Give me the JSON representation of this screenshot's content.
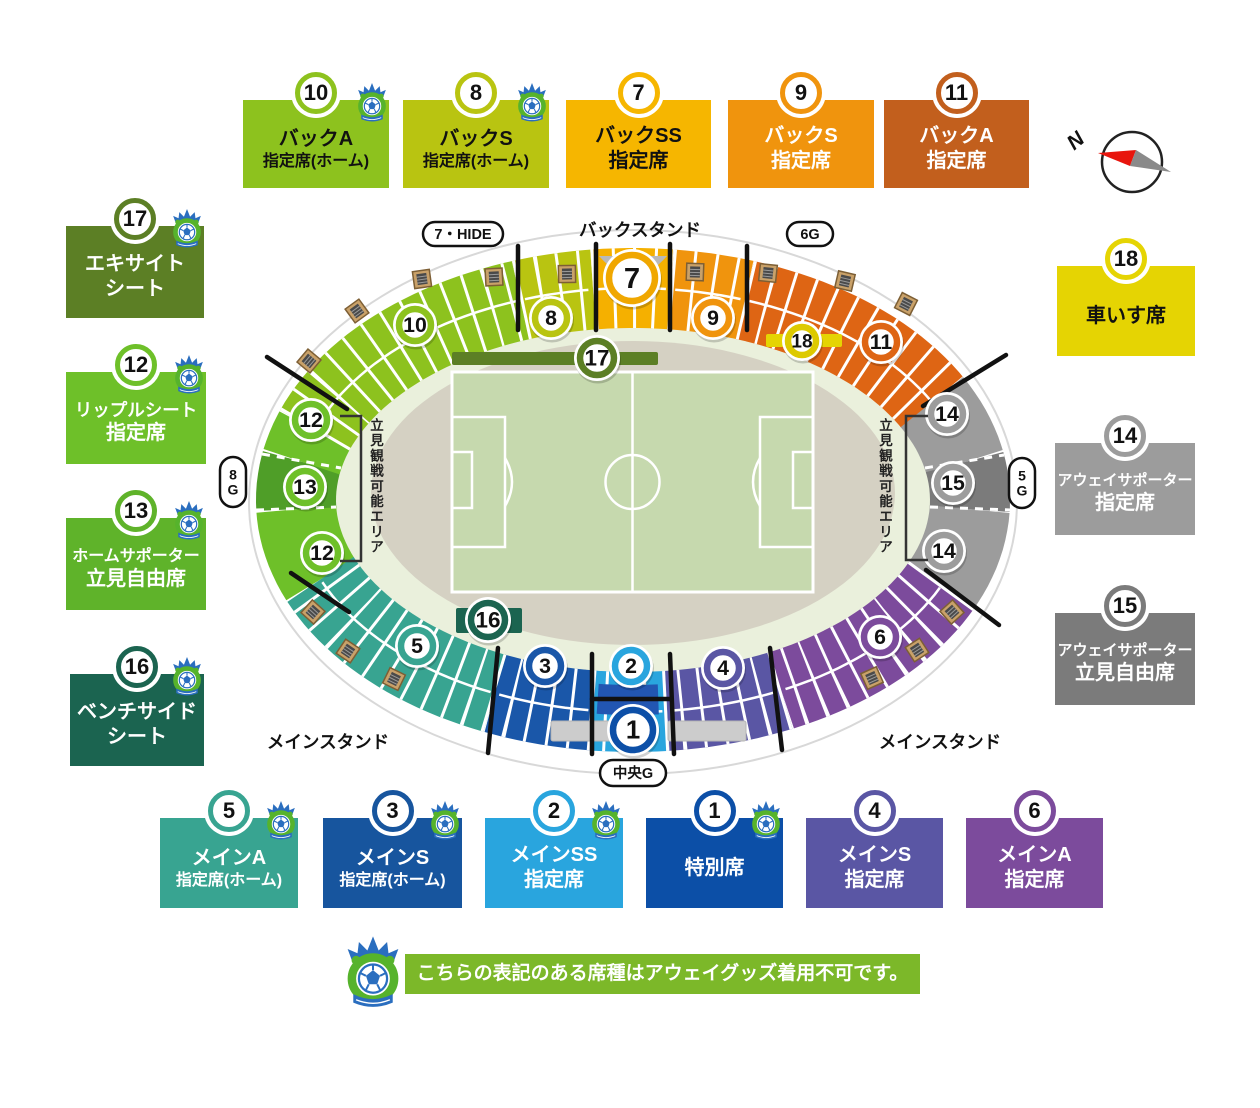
{
  "note": {
    "text": "こちらの表記のある席種はアウェイグッズ着用不可です。"
  },
  "stadium": {
    "center": {
      "x": 633,
      "y": 500
    },
    "ring": {
      "rx": 337,
      "ry": 212,
      "width": 80
    },
    "silhouette": {
      "rx": 384,
      "ry": 272,
      "fill": "#ffffff",
      "stroke": "#d8d8d8"
    },
    "concourse": {
      "rx": 302,
      "ry": 190,
      "cy": 500,
      "fill": "#eaf0dc"
    },
    "track": {
      "rx": 262,
      "ry": 152,
      "cy": 493,
      "fill": "#d5d1c3"
    },
    "field": {
      "x": 452,
      "y": 372,
      "w": 361,
      "h": 220,
      "grass": "#c6d9ae",
      "line": "#ffffff"
    },
    "sections": [
      {
        "id": "12",
        "from": 158,
        "to": 177.5,
        "color": "#6ec029",
        "blocks": false
      },
      {
        "id": "13",
        "from": 177.5,
        "to": 190.4,
        "color": "#4f9e28",
        "blocks": false
      },
      {
        "id": "12",
        "from": 190.4,
        "to": 199.2,
        "color": "#6ec029",
        "blocks": false
      },
      {
        "id": "10",
        "from": 199.2,
        "to": 250.5,
        "color": "#8dc21e",
        "blocks": true
      },
      {
        "id": "8",
        "from": 250.5,
        "to": 263.2,
        "color": "#b9c411",
        "blocks": true
      },
      {
        "id": "7",
        "from": 263.2,
        "to": 276.4,
        "color": "#f5b000",
        "blocks": true
      },
      {
        "id": "9",
        "from": 276.4,
        "to": 289.4,
        "color": "#f0940d",
        "blocks": true
      },
      {
        "id": "11",
        "from": 289.4,
        "to": 332.5,
        "color": "#de6514",
        "blocks": true
      },
      {
        "id": "14",
        "from": 332.5,
        "to": 349.7,
        "color": "#9c9c9c",
        "blocks": false
      },
      {
        "id": "15",
        "from": 349.7,
        "to": 362.5,
        "color": "#7b7b7b",
        "blocks": false
      },
      {
        "id": "14",
        "from": 2.5,
        "to": 23.6,
        "color": "#9c9c9c",
        "blocks": false
      },
      {
        "id": "6",
        "from": 23.6,
        "to": 63.9,
        "color": "#7c4b9c",
        "blocks": true
      },
      {
        "id": "4",
        "from": 63.9,
        "to": 84.2,
        "color": "#5a56a4",
        "blocks": true
      },
      {
        "id": "2",
        "from": 84.2,
        "to": 96.8,
        "color": "#29a5de",
        "blocks": true
      },
      {
        "id": "3",
        "from": 96.8,
        "to": 114.2,
        "color": "#1a57a9",
        "blocks": true
      },
      {
        "id": "5",
        "from": 114.2,
        "to": 158,
        "color": "#38a491",
        "blocks": true
      }
    ],
    "inner_arcs": [
      {
        "id": "1",
        "from": 85.5,
        "to": 96.3,
        "rx": 322,
        "ry": 200,
        "width": 30,
        "color": "#2256b2"
      }
    ],
    "bars": [
      {
        "id": "17",
        "x": 452,
        "y": 352,
        "w": 206,
        "h": 13,
        "color": "#5c7f25"
      },
      {
        "id": "18",
        "x": 766,
        "y": 334,
        "w": 76,
        "h": 13,
        "color": "#e5d403"
      },
      {
        "id": "16",
        "x": 456,
        "y": 608,
        "w": 66,
        "h": 25,
        "color": "#1b6450"
      }
    ],
    "roof": {
      "path": "M599,256 L667,256 Q648,277 633,278 Q618,277 599,256 Z",
      "color": "#b9b9b9"
    },
    "tunnels": [
      {
        "x": 551,
        "y": 721,
        "w": 70,
        "h": 20
      },
      {
        "x": 668,
        "y": 721,
        "w": 78,
        "h": 20
      }
    ],
    "badges": [
      {
        "n": "10",
        "x": 415,
        "y": 325,
        "r": 19,
        "ring": "#8dc21e"
      },
      {
        "n": "8",
        "x": 551,
        "y": 318,
        "r": 19,
        "ring": "#b9c411"
      },
      {
        "n": "7",
        "x": 632,
        "y": 278,
        "r": 26,
        "ring": "#f0a700"
      },
      {
        "n": "9",
        "x": 713,
        "y": 318,
        "r": 19,
        "ring": "#f0940d"
      },
      {
        "n": "11",
        "x": 881,
        "y": 342,
        "r": 19,
        "ring": "#de6514"
      },
      {
        "n": "18",
        "x": 802,
        "y": 341,
        "r": 17,
        "ring": "#ddca00"
      },
      {
        "n": "17",
        "x": 597,
        "y": 358,
        "r": 20,
        "ring": "#5c7f25"
      },
      {
        "n": "12",
        "x": 311,
        "y": 420,
        "r": 19,
        "ring": "#6ec029"
      },
      {
        "n": "13",
        "x": 305,
        "y": 487,
        "r": 19,
        "ring": "#6ec029"
      },
      {
        "n": "12",
        "x": 322,
        "y": 553,
        "r": 19,
        "ring": "#6ec029"
      },
      {
        "n": "14",
        "x": 947,
        "y": 414,
        "r": 19,
        "ring": "#9c9c9c"
      },
      {
        "n": "15",
        "x": 953,
        "y": 483,
        "r": 19,
        "ring": "#9c9c9c"
      },
      {
        "n": "14",
        "x": 944,
        "y": 551,
        "r": 19,
        "ring": "#9c9c9c"
      },
      {
        "n": "5",
        "x": 417,
        "y": 646,
        "r": 19,
        "ring": "#38a491"
      },
      {
        "n": "16",
        "x": 488,
        "y": 620,
        "r": 20,
        "ring": "#1b6450"
      },
      {
        "n": "3",
        "x": 545,
        "y": 666,
        "r": 19,
        "ring": "#1a57a9"
      },
      {
        "n": "2",
        "x": 631,
        "y": 666,
        "r": 19,
        "ring": "#29a5de"
      },
      {
        "n": "1",
        "x": 633,
        "y": 730,
        "r": 23,
        "ring": "#0c4fa7"
      },
      {
        "n": "4",
        "x": 723,
        "y": 668,
        "r": 19,
        "ring": "#5a56a4"
      },
      {
        "n": "6",
        "x": 880,
        "y": 637,
        "r": 19,
        "ring": "#7c4b9c"
      }
    ],
    "doors": [
      {
        "x": 422,
        "y": 279,
        "rot": -8
      },
      {
        "x": 494,
        "y": 277,
        "rot": -3
      },
      {
        "x": 567,
        "y": 274,
        "rot": -1
      },
      {
        "x": 695,
        "y": 272,
        "rot": 2
      },
      {
        "x": 768,
        "y": 273,
        "rot": 6
      },
      {
        "x": 845,
        "y": 281,
        "rot": 13
      },
      {
        "x": 906,
        "y": 304,
        "rot": 27
      },
      {
        "x": 357,
        "y": 311,
        "rot": -36
      },
      {
        "x": 309,
        "y": 361,
        "rot": -50
      },
      {
        "x": 313,
        "y": 612,
        "rot": 42
      },
      {
        "x": 348,
        "y": 651,
        "rot": 34
      },
      {
        "x": 394,
        "y": 679,
        "rot": 26
      },
      {
        "x": 952,
        "y": 612,
        "rot": -42
      },
      {
        "x": 917,
        "y": 650,
        "rot": -33
      },
      {
        "x": 872,
        "y": 678,
        "rot": -24
      }
    ],
    "dividers_black": [
      [
        518,
        246,
        518,
        330
      ],
      [
        596,
        244,
        596,
        330
      ],
      [
        670,
        244,
        670,
        330
      ],
      [
        747,
        246,
        747,
        330
      ],
      [
        267,
        357,
        347,
        409
      ],
      [
        291,
        573,
        349,
        612
      ],
      [
        923,
        406,
        1006,
        355
      ],
      [
        926,
        570,
        999,
        625
      ],
      [
        498,
        648,
        488,
        753
      ],
      [
        592,
        654,
        592,
        754
      ],
      [
        670,
        654,
        674,
        754
      ],
      [
        770,
        648,
        782,
        750
      ],
      [
        592,
        699,
        671,
        699
      ]
    ],
    "dividers_dashed": [
      [
        262,
        454,
        341,
        468
      ],
      [
        256,
        510,
        336,
        507
      ],
      [
        925,
        468,
        1004,
        455
      ],
      [
        930,
        507,
        1010,
        510
      ]
    ],
    "gates": [
      {
        "text": "7・HIDE",
        "x": 463,
        "y": 234,
        "w": 80,
        "h": 24,
        "vertical": false
      },
      {
        "text": "6G",
        "x": 810,
        "y": 234,
        "w": 46,
        "h": 24,
        "vertical": false
      },
      {
        "text": "8G",
        "x": 233,
        "y": 482,
        "w": 26,
        "h": 50,
        "vertical": true
      },
      {
        "text": "5G",
        "x": 1022,
        "y": 483,
        "w": 26,
        "h": 50,
        "vertical": true
      },
      {
        "text": "中央G",
        "x": 633,
        "y": 773,
        "w": 66,
        "h": 26,
        "vertical": false
      }
    ],
    "stand_labels": [
      {
        "text": "バックスタンド",
        "x": 640,
        "y": 236
      },
      {
        "text": "メインスタンド",
        "x": 328,
        "y": 748
      },
      {
        "text": "メインスタンド",
        "x": 940,
        "y": 748
      }
    ],
    "standing_areas": [
      {
        "text": "立見観戦可能エリア",
        "x": 377,
        "y": 430,
        "step": 15.2,
        "bracket": "M340,416 L361,416 L361,561 L340,561"
      },
      {
        "text": "立見観戦可能エリア",
        "x": 886,
        "y": 430,
        "step": 15.2,
        "bracket": "M928,416 L906,416 L906,560 L928,560"
      }
    ],
    "compass": {
      "cx": 1132,
      "cy": 162,
      "r": 30,
      "label": "N",
      "needle_red": "#e8150d",
      "needle_gray": "#8a8a8a"
    }
  },
  "cards": [
    {
      "id": "10",
      "x": 243,
      "y": 100,
      "w": 146,
      "h": 88,
      "bg": "#8dc21e",
      "text": "#111111",
      "lines": [
        "バックA",
        "指定席(ホーム)"
      ],
      "mascot": true
    },
    {
      "id": "8",
      "x": 403,
      "y": 100,
      "w": 146,
      "h": 88,
      "bg": "#b9c411",
      "text": "#111111",
      "lines": [
        "バックS",
        "指定席(ホーム)"
      ],
      "mascot": true
    },
    {
      "id": "7",
      "x": 566,
      "y": 100,
      "w": 145,
      "h": 88,
      "bg": "#f6b600",
      "text": "#111111",
      "lines": [
        "バックSS",
        "指定席"
      ],
      "mascot": false
    },
    {
      "id": "9",
      "x": 728,
      "y": 100,
      "w": 146,
      "h": 88,
      "bg": "#f0940d",
      "text": "#ffffff",
      "lines": [
        "バックS",
        "指定席"
      ],
      "mascot": false
    },
    {
      "id": "11",
      "x": 884,
      "y": 100,
      "w": 145,
      "h": 88,
      "bg": "#c25f1d",
      "text": "#ffffff",
      "lines": [
        "バックA",
        "指定席"
      ],
      "mascot": false
    },
    {
      "id": "17",
      "x": 66,
      "y": 226,
      "w": 138,
      "h": 92,
      "bg": "#5c7f25",
      "text": "#ffffff",
      "lines": [
        "エキサイト",
        "シート"
      ],
      "mascot": true
    },
    {
      "id": "12",
      "x": 66,
      "y": 372,
      "w": 140,
      "h": 92,
      "bg": "#6ec029",
      "text": "#ffffff",
      "lines": [
        "リップルシート",
        "指定席"
      ],
      "mascot": true
    },
    {
      "id": "13",
      "x": 66,
      "y": 518,
      "w": 140,
      "h": 92,
      "bg": "#5fb32a",
      "text": "#ffffff",
      "lines": [
        "ホームサポーター",
        "立見自由席"
      ],
      "mascot": true
    },
    {
      "id": "16",
      "x": 70,
      "y": 674,
      "w": 134,
      "h": 92,
      "bg": "#1b6450",
      "text": "#ffffff",
      "lines": [
        "ベンチサイド",
        "シート"
      ],
      "mascot": true
    },
    {
      "id": "18",
      "x": 1057,
      "y": 266,
      "w": 138,
      "h": 90,
      "bg": "#e5d403",
      "text": "#111111",
      "lines": [
        "車いす席"
      ],
      "mascot": false
    },
    {
      "id": "14",
      "x": 1055,
      "y": 443,
      "w": 140,
      "h": 92,
      "bg": "#9c9c9c",
      "text": "#ffffff",
      "lines": [
        "アウェイサポーター",
        "指定席"
      ],
      "mascot": false
    },
    {
      "id": "15",
      "x": 1055,
      "y": 613,
      "w": 140,
      "h": 92,
      "bg": "#7b7b7b",
      "text": "#ffffff",
      "lines": [
        "アウェイサポーター",
        "立見自由席"
      ],
      "mascot": false
    },
    {
      "id": "5",
      "x": 160,
      "y": 818,
      "w": 138,
      "h": 90,
      "bg": "#38a491",
      "text": "#ffffff",
      "lines": [
        "メインA",
        "指定席(ホーム)"
      ],
      "mascot": true
    },
    {
      "id": "3",
      "x": 323,
      "y": 818,
      "w": 139,
      "h": 90,
      "bg": "#17559e",
      "text": "#ffffff",
      "lines": [
        "メインS",
        "指定席(ホーム)"
      ],
      "mascot": true
    },
    {
      "id": "2",
      "x": 485,
      "y": 818,
      "w": 138,
      "h": 90,
      "bg": "#29a5de",
      "text": "#ffffff",
      "lines": [
        "メインSS",
        "指定席"
      ],
      "mascot": true
    },
    {
      "id": "1",
      "x": 646,
      "y": 818,
      "w": 137,
      "h": 90,
      "bg": "#0c4fa7",
      "text": "#ffffff",
      "lines": [
        "特別席"
      ],
      "mascot": true
    },
    {
      "id": "4",
      "x": 806,
      "y": 818,
      "w": 137,
      "h": 90,
      "bg": "#5a56a4",
      "text": "#ffffff",
      "lines": [
        "メインS",
        "指定席"
      ],
      "mascot": false
    },
    {
      "id": "6",
      "x": 966,
      "y": 818,
      "w": 137,
      "h": 90,
      "bg": "#7c4b9c",
      "text": "#ffffff",
      "lines": [
        "メインA",
        "指定席"
      ],
      "mascot": false
    }
  ]
}
